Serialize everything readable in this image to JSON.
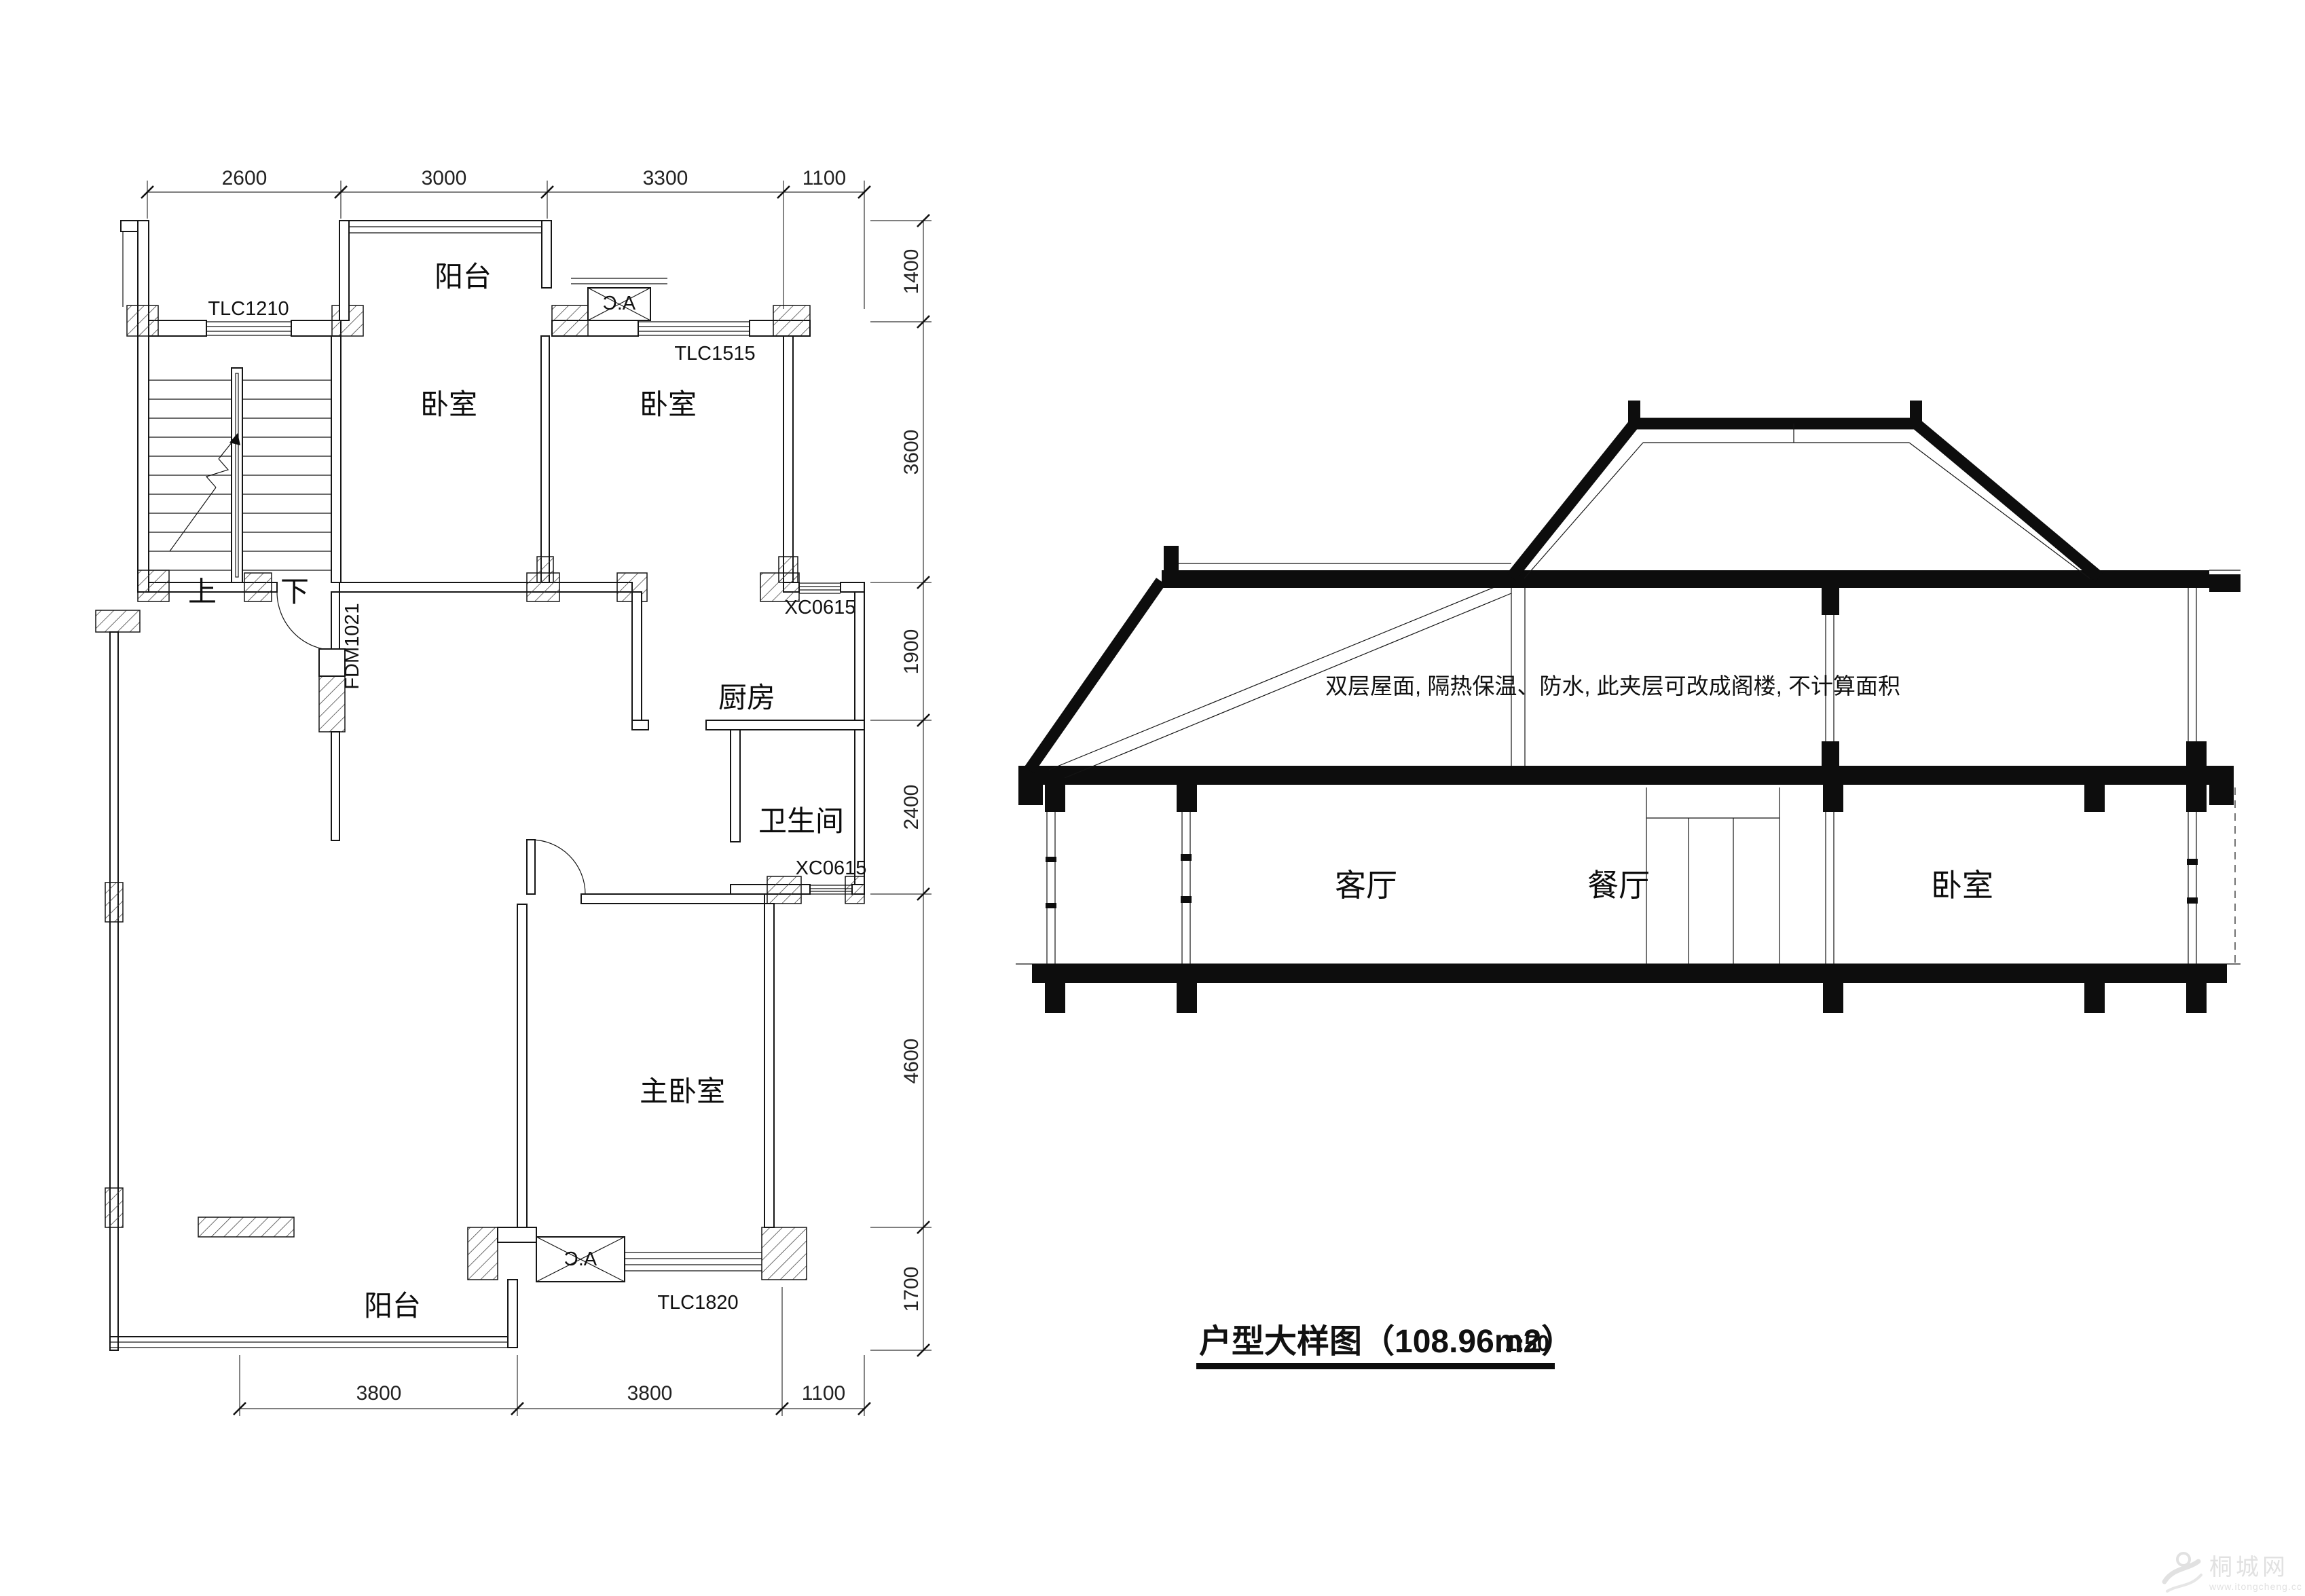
{
  "plan": {
    "dims": {
      "top": [
        "2600",
        "3000",
        "3300",
        "1100"
      ],
      "right": [
        "1400",
        "3600",
        "1900",
        "2400",
        "4600",
        "1700"
      ],
      "bottom": [
        "3800",
        "3800",
        "1100"
      ]
    },
    "rooms": {
      "balcony_top": "阳台",
      "bedroom_left": "卧室",
      "bedroom_right": "卧室",
      "kitchen": "厨房",
      "bathroom": "卫生间",
      "master_bedroom": "主卧室",
      "balcony_bottom": "阳台"
    },
    "openings": {
      "tlc1210": "TLC1210",
      "tlc1515": "TLC1515",
      "xc0615_top": "XC0615",
      "xc0615_bottom": "XC0615",
      "tlc1820": "TLC1820",
      "fdm1021": "FDM1021"
    },
    "stair": {
      "up": "上",
      "down": "下"
    },
    "ac_label": "A.C"
  },
  "section": {
    "note": "双层屋面, 隔热保温、防水, 此夹层可改成阁楼, 不计算面积",
    "rooms": {
      "living": "客厅",
      "dining": "餐厅",
      "bedroom": "卧室"
    }
  },
  "title": {
    "text": "户型大样图（108.96m2）",
    "scale": "1:50"
  },
  "watermark": {
    "name": "桐城网",
    "url": "www.itongcheng.cc"
  },
  "colors": {
    "line": "#151515",
    "slab": "#0d0d0d",
    "watermark": "#dcdcdc"
  }
}
